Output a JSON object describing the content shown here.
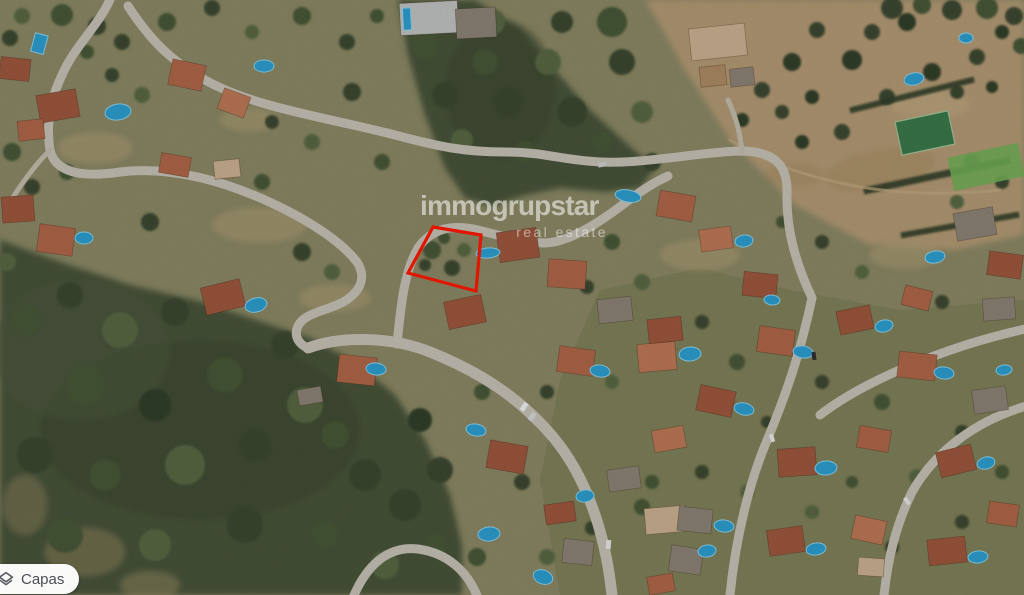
{
  "watermark": {
    "brand": "immogrupstar",
    "tagline": "real estate"
  },
  "plot_outline": {
    "points": "433,227 481,235 476,291 408,273",
    "color": "#e11500"
  },
  "controls": {
    "layers_button_label": "Capas"
  },
  "map_palette": {
    "forest": "#49543a",
    "dry_field": "#b49b76",
    "road": "#c8c4b8",
    "pool_blue": "#2da0d2",
    "roof_terracotta": "#a85c42",
    "plot_red": "#e11500"
  }
}
